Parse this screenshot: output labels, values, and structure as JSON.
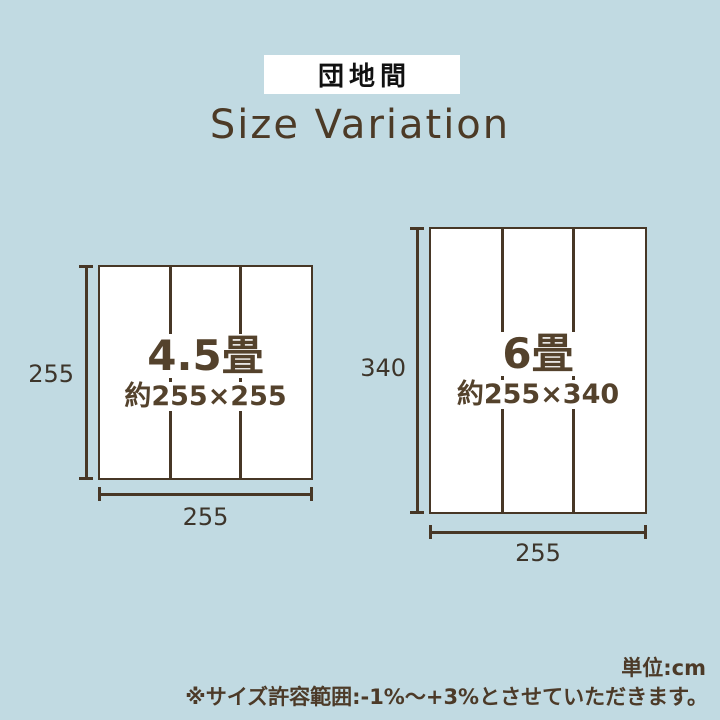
{
  "badge": {
    "label": "団地間"
  },
  "title": {
    "text": "Size Variation"
  },
  "diagrams": [
    {
      "size_name": "4.5畳",
      "approx_label": "約255×255",
      "height_label": "255",
      "width_label": "255",
      "panels": 3
    },
    {
      "size_name": "6畳",
      "approx_label": "約255×340",
      "height_label": "340",
      "width_label": "255",
      "panels": 3
    }
  ],
  "footer": {
    "unit": "単位:cm",
    "note": "※サイズ許容範囲:-1%〜+3%とさせていただきます。"
  },
  "colors": {
    "background": "#c1dae2",
    "line_brown": "#473726",
    "text_brown": "#54422c",
    "title_brown": "#4c3a26",
    "dim_label": "#3d352b",
    "badge_bg": "#ffffff",
    "badge_text": "#111111"
  }
}
